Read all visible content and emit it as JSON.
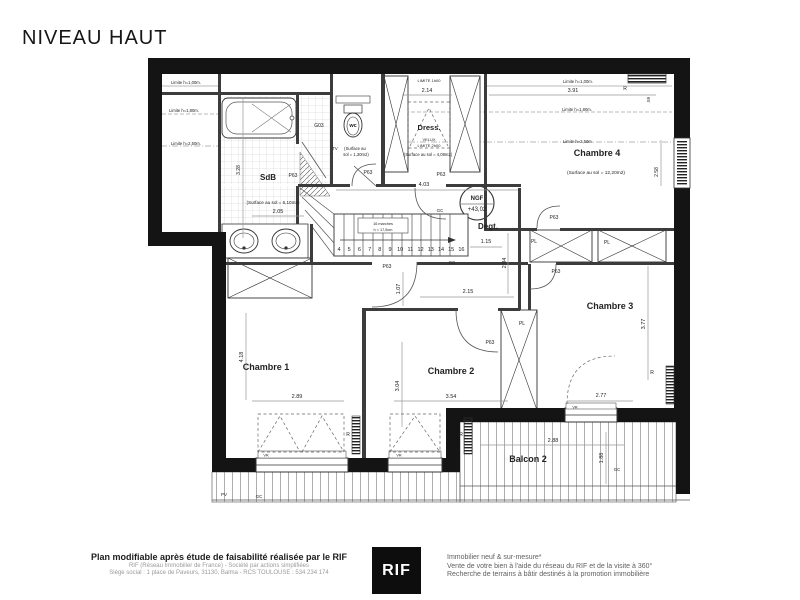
{
  "title": "NIVEAU HAUT",
  "footer": {
    "left_bold": "Plan modifiable après étude de faisabilité réalisée par le RIF",
    "left_line1": "RIF (Réseau Immobilier de France) - Société par actions simplifiées",
    "left_line2": "Siège social : 1 place de Paveurs, 31130, Balma - RCS TOULOUSE : 534 234 174",
    "logo_text": "RIF",
    "right_line1": "Immobilier neuf & sur-mesure*",
    "right_line2": "Vente de votre bien à l'aide du réseau du RIF et de la visite à 360°",
    "right_line3": "Recherche de terrains à bâtir destinés à la promotion immobilière"
  },
  "plan": {
    "level_reference": "NGF +43,02",
    "rooms": [
      "SdB",
      "wc",
      "Dress.",
      "Degt.",
      "Chambre 1",
      "Chambre 2",
      "Chambre 3",
      "Chambre 4",
      "Balcon 2"
    ],
    "stairs": {
      "steps": [
        "4",
        "5",
        "6",
        "7",
        "8",
        "9",
        "10",
        "11",
        "12",
        "13",
        "14",
        "15",
        "16"
      ],
      "note1": "16 marches",
      "note2": "h = 17,5cm"
    },
    "labels": [
      {
        "t": "SdB",
        "x": 268,
        "y": 180,
        "s": 8,
        "b": 1
      },
      {
        "t": "Dress.",
        "x": 429,
        "y": 130,
        "s": 7.5,
        "b": 1
      },
      {
        "t": "Degt.",
        "x": 488,
        "y": 229,
        "s": 8,
        "b": 1
      },
      {
        "t": "Chambre 1",
        "x": 266,
        "y": 370,
        "s": 9,
        "b": 1
      },
      {
        "t": "Chambre 2",
        "x": 451,
        "y": 374,
        "s": 9,
        "b": 1
      },
      {
        "t": "Chambre 3",
        "x": 610,
        "y": 309,
        "s": 9,
        "b": 1
      },
      {
        "t": "Chambre 4",
        "x": 597,
        "y": 156,
        "s": 9,
        "b": 1
      },
      {
        "t": "Balcon 2",
        "x": 528,
        "y": 462,
        "s": 9,
        "b": 1
      },
      {
        "t": "wc",
        "x": 353,
        "y": 127,
        "s": 5.5,
        "b": 1
      },
      {
        "t": "NGF",
        "x": 477,
        "y": 200,
        "s": 6,
        "b": 1
      },
      {
        "t": "+43,02",
        "x": 477,
        "y": 211,
        "s": 6
      },
      {
        "t": "(Surface au sol = 6,10m2)",
        "x": 273,
        "y": 204,
        "s": 4.6
      },
      {
        "t": "TV",
        "x": 335,
        "y": 150,
        "s": 4.2
      },
      {
        "t": "(Surface au",
        "x": 355,
        "y": 150,
        "s": 4.2
      },
      {
        "t": "sol = 1,30m2)",
        "x": 356,
        "y": 156,
        "s": 4.2
      },
      {
        "t": "(Surface au sol = 4,08m2)",
        "x": 428,
        "y": 156,
        "s": 4.2
      },
      {
        "t": "(Surface au sol = 12,20m2)",
        "x": 596,
        "y": 174,
        "s": 4.8
      },
      {
        "t": "2.14",
        "x": 427,
        "y": 92,
        "s": 5.5
      },
      {
        "t": "3.91",
        "x": 573,
        "y": 92,
        "s": 5.5
      },
      {
        "t": "4.03",
        "x": 424,
        "y": 186,
        "s": 5.5
      },
      {
        "t": "1.15",
        "x": 486,
        "y": 243,
        "s": 5.5
      },
      {
        "t": "2.15",
        "x": 468,
        "y": 293,
        "s": 5.5
      },
      {
        "t": "2.94",
        "x": 506,
        "y": 263,
        "s": 5.5,
        "r": 1
      },
      {
        "t": "1.07",
        "x": 400,
        "y": 289,
        "s": 5.5,
        "r": 1
      },
      {
        "t": "2.89",
        "x": 297,
        "y": 398,
        "s": 5.5
      },
      {
        "t": "4.18",
        "x": 243,
        "y": 357,
        "s": 5.5,
        "r": 1
      },
      {
        "t": "3.04",
        "x": 399,
        "y": 386,
        "s": 5.5,
        "r": 1
      },
      {
        "t": "3.54",
        "x": 451,
        "y": 398,
        "s": 5.5
      },
      {
        "t": "3.77",
        "x": 645,
        "y": 324,
        "s": 5.5,
        "r": 1
      },
      {
        "t": "2.77",
        "x": 601,
        "y": 397,
        "s": 5.5
      },
      {
        "t": "2.88",
        "x": 553,
        "y": 442,
        "s": 5.5
      },
      {
        "t": "1.88",
        "x": 603,
        "y": 458,
        "s": 5.5,
        "r": 1
      },
      {
        "t": "2.05",
        "x": 278,
        "y": 213,
        "s": 5.5
      },
      {
        "t": "3.28",
        "x": 240,
        "y": 170,
        "s": 5,
        "r": 1
      },
      {
        "t": "2.58",
        "x": 658,
        "y": 172,
        "s": 5,
        "r": 1
      },
      {
        "t": ".59",
        "x": 650,
        "y": 100,
        "s": 4.5,
        "r": 1
      },
      {
        "t": "Limite h=1,00m.",
        "x": 186,
        "y": 84,
        "s": 4.2
      },
      {
        "t": "Limite h=1,80m.",
        "x": 184,
        "y": 112,
        "s": 4.2
      },
      {
        "t": "Limite h=2,50m.",
        "x": 186,
        "y": 145,
        "s": 4.2
      },
      {
        "t": "Limite h=1,00m.",
        "x": 578,
        "y": 83,
        "s": 4.2
      },
      {
        "t": "Limite h=1,80m.",
        "x": 577,
        "y": 111,
        "s": 4.2
      },
      {
        "t": "Limite h=2,50m.",
        "x": 578,
        "y": 143,
        "s": 4.2
      },
      {
        "t": "LIMITE 1h00",
        "x": 429,
        "y": 82,
        "s": 4
      },
      {
        "t": "VELUX",
        "x": 429,
        "y": 141,
        "s": 4
      },
      {
        "t": "LIMITE 2h00",
        "x": 429,
        "y": 147,
        "s": 4
      },
      {
        "t": "P63",
        "x": 293,
        "y": 177,
        "s": 5
      },
      {
        "t": "P63",
        "x": 368,
        "y": 174,
        "s": 5
      },
      {
        "t": "P63",
        "x": 441,
        "y": 176,
        "s": 5
      },
      {
        "t": "P63",
        "x": 387,
        "y": 268,
        "s": 5
      },
      {
        "t": "P63",
        "x": 490,
        "y": 344,
        "s": 5
      },
      {
        "t": "P63",
        "x": 554,
        "y": 219,
        "s": 5
      },
      {
        "t": "P63",
        "x": 556,
        "y": 273,
        "s": 5
      },
      {
        "t": "G03",
        "x": 319,
        "y": 127,
        "s": 5
      },
      {
        "t": "PL",
        "x": 522,
        "y": 325,
        "s": 5
      },
      {
        "t": "PL",
        "x": 534,
        "y": 243,
        "s": 5
      },
      {
        "t": "PL",
        "x": 607,
        "y": 244,
        "s": 5
      },
      {
        "t": "R",
        "x": 625,
        "y": 90,
        "s": 5
      },
      {
        "t": "R",
        "x": 652,
        "y": 374,
        "s": 5
      },
      {
        "t": "R",
        "x": 461,
        "y": 436,
        "s": 5
      },
      {
        "t": "R",
        "x": 348,
        "y": 436,
        "s": 5
      },
      {
        "t": "VR",
        "x": 266,
        "y": 456.5,
        "s": 3.8
      },
      {
        "t": "VR",
        "x": 399,
        "y": 456.5,
        "s": 3.8
      },
      {
        "t": "VR",
        "x": 575,
        "y": 408.5,
        "s": 3.8
      },
      {
        "t": "GC",
        "x": 440,
        "y": 212,
        "s": 4.5
      },
      {
        "t": "GC",
        "x": 452,
        "y": 264,
        "s": 4.5
      },
      {
        "t": "GC",
        "x": 617,
        "y": 471,
        "s": 4.5
      },
      {
        "t": "GC",
        "x": 259,
        "y": 498,
        "s": 4.5
      },
      {
        "t": "PV",
        "x": 224,
        "y": 496,
        "s": 4.5
      },
      {
        "t": "16 marches",
        "x": 383,
        "y": 225,
        "s": 3.8
      },
      {
        "t": "h = 17,5cm",
        "x": 383,
        "y": 231,
        "s": 3.8
      }
    ]
  }
}
